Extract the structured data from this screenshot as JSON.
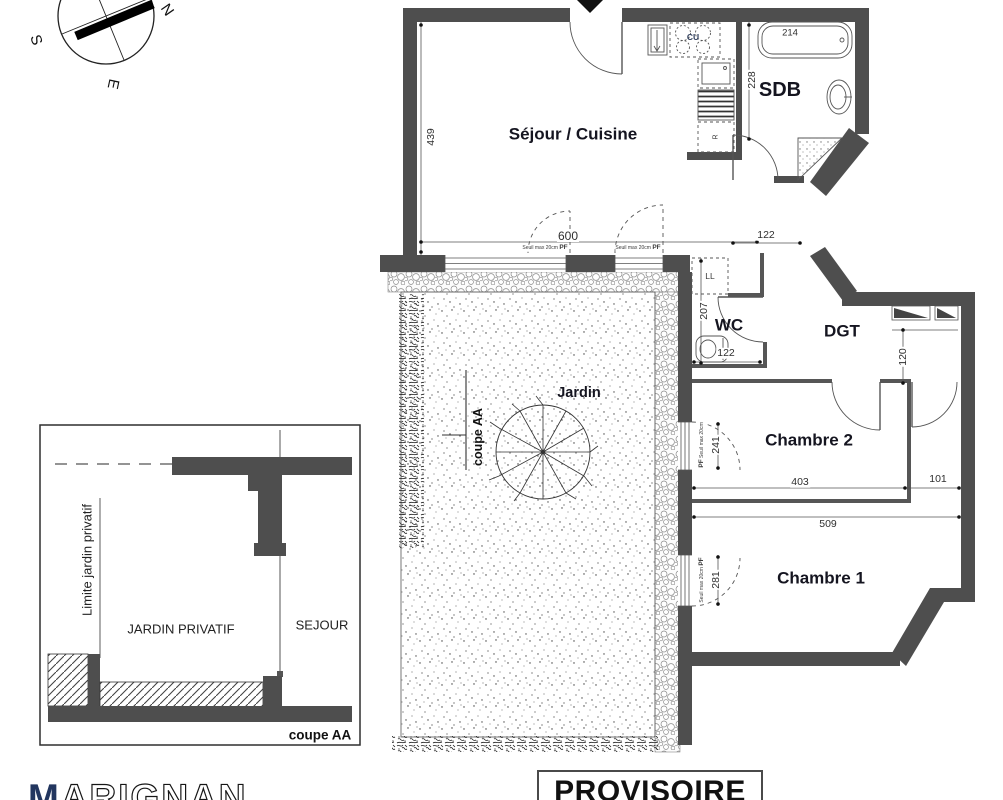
{
  "compass": {
    "north": "N",
    "south": "S",
    "east": "E"
  },
  "plan": {
    "rooms": {
      "sejour_cuisine": "Séjour / Cuisine",
      "sdb": "SDB",
      "wc": "WC",
      "dgt": "DGT",
      "chambre2": "Chambre 2",
      "chambre1": "Chambre 1",
      "jardin": "Jardin"
    },
    "appliances": {
      "hob": "CU",
      "fridge": "R",
      "washer": "LL"
    },
    "dims": {
      "sejour_height": "439",
      "sejour_width": "600",
      "entry": "122",
      "sdb_height": "228",
      "bathtub": "214",
      "wc_height": "207",
      "wc_width": "122",
      "dgt_window": "120",
      "ch2_window": "241",
      "ch2_width": "403",
      "passage": "101",
      "ch1_width": "509",
      "ch1_window": "281"
    },
    "window_note": "Seuil max 20cm",
    "window_tag": "PF"
  },
  "section": {
    "title": "coupe AA",
    "line_label": "coupe AA",
    "limit": "Limite jardin privatif",
    "garden": "JARDIN PRIVATIF",
    "living": "SEJOUR"
  },
  "footer": {
    "brand_first": "M",
    "brand_rest": "ARIGNAN",
    "stamp": "PROVISOIRE"
  },
  "colors": {
    "wall": "#4e4e4e",
    "ink": "#1a1a1a",
    "dim": "#2f2f2f",
    "brand_navy": "#22365f"
  }
}
